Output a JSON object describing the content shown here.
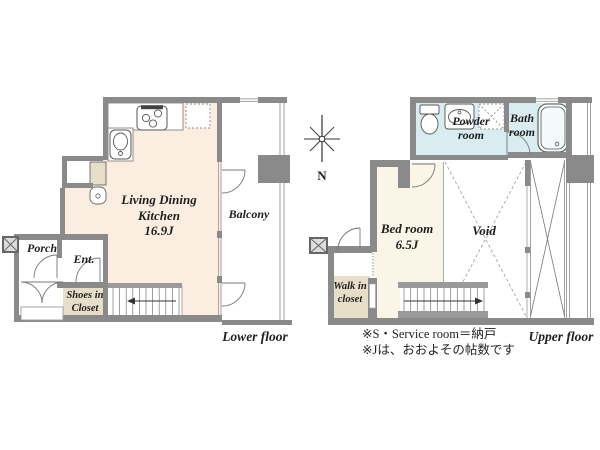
{
  "lower": {
    "ldk_line1": "Living Dining",
    "ldk_line2": "Kitchen",
    "ldk_size": "16.9J",
    "balcony": "Balcony",
    "porch": "Porch",
    "entrance": "Ent.",
    "shoes_line1": "Shoes in",
    "shoes_line2": "Closet",
    "caption": "Lower floor"
  },
  "upper": {
    "powder_line1": "Powder",
    "powder_line2": "room",
    "bath_line1": "Bath",
    "bath_line2": "room",
    "bedroom_name": "Bed room",
    "bedroom_size": "6.5J",
    "void_label": "Void",
    "wic_line1": "Walk in",
    "wic_line2": "closet",
    "caption": "Upper floor"
  },
  "compass_label": "N",
  "notes": {
    "line1": "※S・Service room＝納戸",
    "line2": "※Jは、おおよその帖数です"
  },
  "colors": {
    "wall_gray": "#8a8a8a",
    "ldk_fill": "#fbeee0",
    "bedroom_fill": "#f9f6e7",
    "wet_area_fill": "#d9edf0",
    "closet_fill": "#e7dec8",
    "stair_gray": "#9a9a9a",
    "line_dark": "#555555",
    "text": "#1f1f1f"
  }
}
